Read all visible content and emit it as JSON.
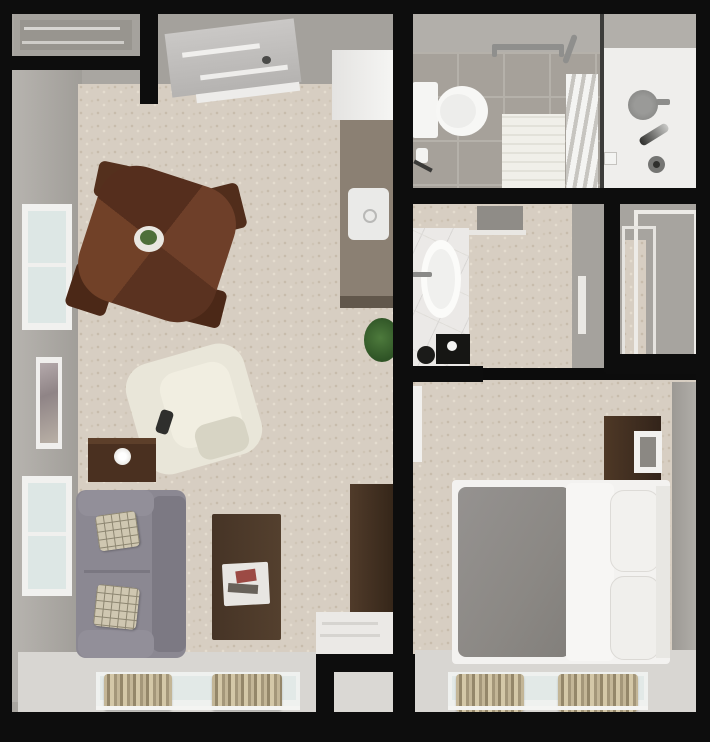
{
  "scene": {
    "width": 710,
    "height": 745,
    "type": "3d-top-view-floor-plan"
  },
  "palette": {
    "wall_line": "#0d0d0d",
    "wall_face": "#a9a6a1",
    "carpet": "#d7cec2",
    "bay_floor": "#d8d6d2",
    "tile": "#a6a19a",
    "counter": "#8b8073",
    "wood_dark": "#4b2817",
    "wood_walnut": "#4c3827",
    "sofa_gray": "#8b8892",
    "recliner_cream": "#e9e6d9",
    "bed_gray": "#8f8c88",
    "curtain_tan": "#b3a687",
    "plant_green": "#4d7a3c",
    "fixture_white": "#f5f5f3"
  },
  "primitives": [
    {
      "n": "living-unit-wall-base",
      "x": 12,
      "y": 12,
      "w": 383,
      "h": 700,
      "bg": "#a9a6a1"
    },
    {
      "n": "living-west-wall-face",
      "x": 12,
      "y": 68,
      "w": 70,
      "h": 634,
      "bg": "linear-gradient(90deg,#b7b4af,#a09d98)"
    },
    {
      "n": "entry-ceiling-area",
      "x": 150,
      "y": 12,
      "w": 245,
      "h": 100,
      "bg": "#a4a19c"
    },
    {
      "n": "living-room-carpet",
      "x": 78,
      "y": 84,
      "w": 317,
      "h": 576,
      "cls": "carpet"
    },
    {
      "n": "living-window-bay-floor",
      "x": 18,
      "y": 652,
      "w": 377,
      "h": 60,
      "bg": "#d8d6d2"
    },
    {
      "n": "bathroom-base",
      "x": 411,
      "y": 12,
      "w": 285,
      "h": 178,
      "bg": "#b2afaa"
    },
    {
      "n": "bathroom-tile-floor",
      "x": 411,
      "y": 52,
      "w": 192,
      "h": 138,
      "cls": "tile"
    },
    {
      "n": "shower-floor",
      "x": 603,
      "y": 48,
      "w": 93,
      "h": 142,
      "bg": "#efeeec"
    },
    {
      "n": "dressing-room-carpet",
      "x": 411,
      "y": 204,
      "w": 194,
      "h": 164,
      "cls": "carpet"
    },
    {
      "n": "dressing-east-wall-face",
      "x": 572,
      "y": 204,
      "w": 32,
      "h": 164,
      "bg": "#a5a29d"
    },
    {
      "n": "closet-base",
      "x": 620,
      "y": 204,
      "w": 76,
      "h": 154,
      "bg": "#a7a49f"
    },
    {
      "n": "closet-carpet-sliver",
      "x": 622,
      "y": 240,
      "w": 24,
      "h": 116,
      "cls": "carpet"
    },
    {
      "n": "bedroom-carpet",
      "x": 411,
      "y": 380,
      "w": 285,
      "h": 274,
      "cls": "carpet"
    },
    {
      "n": "bedroom-window-bay-floor",
      "x": 415,
      "y": 650,
      "w": 281,
      "h": 62,
      "bg": "#d8d6d2"
    },
    {
      "n": "bedroom-east-wall-face",
      "x": 672,
      "y": 382,
      "w": 24,
      "h": 268,
      "bg": "linear-gradient(270deg,#b0ada8,#9c9994)"
    },
    {
      "n": "utility-nook-floor",
      "x": 334,
      "y": 670,
      "w": 58,
      "h": 44,
      "bg": "#dad8d4"
    },
    {
      "n": "entry-alcove",
      "x": 14,
      "y": 14,
      "w": 126,
      "h": 42,
      "bg": "#a5a29d"
    },
    {
      "n": "entry-alcove-shelf",
      "x": 20,
      "y": 20,
      "w": 112,
      "h": 30,
      "bg": "#98958f"
    },
    {
      "n": "alcove-shelf-line-1",
      "x": 24,
      "y": 27,
      "w": 96,
      "h": 3,
      "bg": "#d8d6d2"
    },
    {
      "n": "alcove-shelf-line-2",
      "x": 22,
      "y": 41,
      "w": 102,
      "h": 3,
      "bg": "#cfcdc9"
    },
    {
      "n": "entry-door-panel",
      "x": 168,
      "y": 26,
      "w": 130,
      "h": 64,
      "bg": "linear-gradient(180deg,#cac8c6,#b5b3b1)",
      "rot": -7
    },
    {
      "n": "entry-door-stripe-1",
      "x": 182,
      "y": 48,
      "w": 78,
      "h": 5,
      "bg": "#f0efed",
      "rot": -7
    },
    {
      "n": "entry-door-stripe-2",
      "x": 200,
      "y": 70,
      "w": 88,
      "h": 5,
      "bg": "#eeedeb",
      "rot": -7
    },
    {
      "n": "entry-door-handle",
      "x": 262,
      "y": 56,
      "w": 9,
      "h": 8,
      "bg": "#4a4a48",
      "r": "50%"
    },
    {
      "n": "entry-door-threshold",
      "x": 196,
      "y": 88,
      "w": 104,
      "h": 9,
      "bg": "#edecea",
      "rot": -7
    },
    {
      "n": "refrigerator",
      "x": 332,
      "y": 50,
      "w": 64,
      "h": 70,
      "bg": "linear-gradient(90deg,#e4e3e1,#f6f6f4)"
    },
    {
      "n": "kitchen-counter",
      "x": 340,
      "y": 120,
      "w": 57,
      "h": 188,
      "bg": "#8b8073"
    },
    {
      "n": "kitchen-counter-edge",
      "x": 340,
      "y": 296,
      "w": 57,
      "h": 12,
      "bg": "#61574b"
    },
    {
      "n": "kitchen-sink",
      "x": 348,
      "y": 188,
      "w": 41,
      "h": 52,
      "bg": "#eaeae8",
      "r": "6px"
    },
    {
      "n": "kitchen-faucet",
      "x": 363,
      "y": 209,
      "w": 10,
      "h": 10,
      "bg": "transparent",
      "b": "2px solid #b9b9b7",
      "r": "50%"
    },
    {
      "n": "potted-plant",
      "x": 364,
      "y": 318,
      "w": 36,
      "h": 44,
      "bg": "radial-gradient(circle at 45% 45%,#4d7a3c,#2f5426 70%)",
      "r": "50%"
    },
    {
      "n": "west-window-1-frame",
      "x": 22,
      "y": 204,
      "w": 50,
      "h": 126,
      "bg": "#f1f1ef"
    },
    {
      "n": "west-window-1-glass",
      "x": 28,
      "y": 211,
      "w": 38,
      "h": 112,
      "bg": "#dde7e5"
    },
    {
      "n": "west-window-1-mullion",
      "x": 28,
      "y": 263,
      "w": 38,
      "h": 4,
      "bg": "#f0f0ee"
    },
    {
      "n": "wall-artwork-frame",
      "x": 36,
      "y": 357,
      "w": 26,
      "h": 92,
      "bg": "#f0efed"
    },
    {
      "n": "wall-artwork-print",
      "x": 40,
      "y": 363,
      "w": 18,
      "h": 80,
      "bg": "linear-gradient(160deg,#b4a9ab 0%,#8f8486 40%,#b9b0a6 100%)"
    },
    {
      "n": "west-window-2-frame",
      "x": 22,
      "y": 476,
      "w": 50,
      "h": 120,
      "bg": "#f1f1ef"
    },
    {
      "n": "west-window-2-glass",
      "x": 28,
      "y": 483,
      "w": 38,
      "h": 106,
      "bg": "#dde7e5"
    },
    {
      "n": "west-window-2-mullion",
      "x": 28,
      "y": 532,
      "w": 38,
      "h": 4,
      "bg": "#f0f0ee"
    },
    {
      "n": "dining-chair-top",
      "x": 96,
      "y": 164,
      "w": 42,
      "h": 36,
      "bg": "#54301d",
      "r": "6px",
      "rot": 12
    },
    {
      "n": "dining-chair-right",
      "x": 203,
      "y": 186,
      "w": 40,
      "h": 46,
      "bg": "#512d1b",
      "r": "6px",
      "rot": -14
    },
    {
      "n": "dining-chair-bottom",
      "x": 176,
      "y": 286,
      "w": 48,
      "h": 38,
      "bg": "#4b2817",
      "r": "6px",
      "rot": 14
    },
    {
      "n": "dining-chair-left",
      "x": 70,
      "y": 266,
      "w": 42,
      "h": 46,
      "bg": "#4b2817",
      "r": "6px",
      "rot": 18
    },
    {
      "n": "dining-table",
      "x": 86,
      "y": 174,
      "w": 142,
      "h": 140,
      "bg": "conic-gradient(from 20deg,#6e3f29 0 25%,#5a3220 0 50%,#714128 0 75%,#552e1d 0 100%)",
      "r": "28%",
      "rot": 18
    },
    {
      "n": "table-centerpiece-plate",
      "x": 134,
      "y": 226,
      "w": 30,
      "h": 26,
      "bg": "#e9e7e1",
      "r": "50%"
    },
    {
      "n": "table-centerpiece-plant",
      "x": 140,
      "y": 230,
      "w": 17,
      "h": 15,
      "bg": "#4e6f3a",
      "r": "50%"
    },
    {
      "n": "recliner-body",
      "x": 133,
      "y": 352,
      "w": 122,
      "h": 114,
      "bg": "#e9e6d9",
      "r": "26px",
      "rot": -16
    },
    {
      "n": "recliner-seat",
      "x": 165,
      "y": 366,
      "w": 72,
      "h": 78,
      "bg": "#f1eee1",
      "r": "18px",
      "rot": -16
    },
    {
      "n": "recliner-arm-shadow",
      "x": 196,
      "y": 420,
      "w": 52,
      "h": 36,
      "bg": "#d7d4c4",
      "r": "12px",
      "rot": -16
    },
    {
      "n": "recliner-remote",
      "x": 158,
      "y": 410,
      "w": 13,
      "h": 24,
      "bg": "#2f2f2d",
      "r": "4px",
      "rot": 18
    },
    {
      "n": "side-table",
      "x": 88,
      "y": 438,
      "w": 68,
      "h": 44,
      "bg": "#4a3020"
    },
    {
      "n": "side-table-top-edge",
      "x": 88,
      "y": 438,
      "w": 68,
      "h": 6,
      "bg": "#5d3f2a"
    },
    {
      "n": "table-lamp",
      "x": 114,
      "y": 448,
      "w": 17,
      "h": 17,
      "bg": "radial-gradient(circle,#ffffff 30%,#d9d7d1)",
      "r": "50%"
    },
    {
      "n": "sofa-body",
      "x": 76,
      "y": 490,
      "w": 110,
      "h": 168,
      "bg": "#8b8892",
      "r": "10px"
    },
    {
      "n": "sofa-back-cushion",
      "x": 152,
      "y": 496,
      "w": 34,
      "h": 156,
      "bg": "#7c7983",
      "r": "8px"
    },
    {
      "n": "sofa-arm-top",
      "x": 78,
      "y": 490,
      "w": 76,
      "h": 26,
      "bg": "#928f99",
      "r": "10px"
    },
    {
      "n": "sofa-arm-bottom",
      "x": 78,
      "y": 630,
      "w": 76,
      "h": 28,
      "bg": "#928f99",
      "r": "10px"
    },
    {
      "n": "sofa-seat-seam",
      "x": 84,
      "y": 570,
      "w": 66,
      "h": 3,
      "bg": "#7a7781"
    },
    {
      "n": "sofa-pillow-1",
      "x": 97,
      "y": 513,
      "w": 41,
      "h": 36,
      "cls": "plaid",
      "rot": -8
    },
    {
      "n": "sofa-pillow-2",
      "x": 95,
      "y": 586,
      "w": 43,
      "h": 42,
      "cls": "plaid",
      "rot": 6
    },
    {
      "n": "coffee-table",
      "x": 212,
      "y": 514,
      "w": 69,
      "h": 126,
      "bg": "linear-gradient(90deg,#463426,#54402e)",
      "r": "2px"
    },
    {
      "n": "magazine-stack",
      "x": 223,
      "y": 563,
      "w": 46,
      "h": 42,
      "bg": "#e8e6e2",
      "r": "2px",
      "rot": -3
    },
    {
      "n": "magazine-red",
      "x": 236,
      "y": 570,
      "w": 20,
      "h": 12,
      "bg": "#9c4a44",
      "rot": -8
    },
    {
      "n": "magazine-dark",
      "x": 228,
      "y": 584,
      "w": 30,
      "h": 9,
      "bg": "#68625a",
      "rot": 4
    },
    {
      "n": "wardrobe-cabinet",
      "x": 350,
      "y": 484,
      "w": 44,
      "h": 130,
      "bg": "linear-gradient(90deg,#503b2a,#352619)"
    },
    {
      "n": "white-dresser",
      "x": 316,
      "y": 612,
      "w": 78,
      "h": 44,
      "bg": "#ebe9e6"
    },
    {
      "n": "white-dresser-line-1",
      "x": 322,
      "y": 622,
      "w": 56,
      "h": 3,
      "bg": "#d6d4d0"
    },
    {
      "n": "white-dresser-line-2",
      "x": 320,
      "y": 634,
      "w": 60,
      "h": 3,
      "bg": "#d6d4d0"
    },
    {
      "n": "living-south-window-frame",
      "x": 96,
      "y": 672,
      "w": 204,
      "h": 38,
      "bg": "#eff1ef"
    },
    {
      "n": "living-south-window-glass",
      "x": 100,
      "y": 676,
      "w": 196,
      "h": 24,
      "bg": "#e2e9e7"
    },
    {
      "n": "living-south-curtain-left",
      "x": 104,
      "y": 674,
      "w": 68,
      "h": 36,
      "cls": "curtain"
    },
    {
      "n": "living-south-curtain-right",
      "x": 212,
      "y": 674,
      "w": 70,
      "h": 36,
      "cls": "curtain"
    },
    {
      "n": "living-south-window-sill",
      "x": 96,
      "y": 706,
      "w": 204,
      "h": 4,
      "bg": "#f4f4f2"
    },
    {
      "n": "toilet-tank",
      "x": 412,
      "y": 82,
      "w": 26,
      "h": 56,
      "bg": "#f5f5f3",
      "r": "3px"
    },
    {
      "n": "toilet-bowl",
      "x": 436,
      "y": 86,
      "w": 52,
      "h": 50,
      "bg": "#f7f7f5",
      "r": "50%"
    },
    {
      "n": "toilet-seat-shadow",
      "x": 440,
      "y": 94,
      "w": 36,
      "h": 34,
      "bg": "#ededeb",
      "r": "50%"
    },
    {
      "n": "toilet-paper-roll",
      "x": 416,
      "y": 148,
      "w": 12,
      "h": 15,
      "bg": "#f3f3f1",
      "r": "3px"
    },
    {
      "n": "toilet-paper-bracket",
      "x": 413,
      "y": 164,
      "w": 20,
      "h": 4,
      "bg": "#3a3a38",
      "rot": 28
    },
    {
      "n": "bath-mat",
      "x": 502,
      "y": 114,
      "w": 63,
      "h": 74,
      "cls": "mat"
    },
    {
      "n": "grab-bar",
      "x": 492,
      "y": 44,
      "w": 72,
      "h": 6,
      "bg": "#8f8f8d",
      "r": "3px"
    },
    {
      "n": "grab-bar-end-left",
      "x": 492,
      "y": 44,
      "w": 5,
      "h": 13,
      "bg": "#8f8f8d",
      "r": "2px"
    },
    {
      "n": "grab-bar-end-right",
      "x": 559,
      "y": 44,
      "w": 5,
      "h": 13,
      "bg": "#8f8f8d",
      "r": "2px"
    },
    {
      "n": "grab-bar-angled",
      "x": 567,
      "y": 34,
      "w": 6,
      "h": 30,
      "bg": "#8f8f8d",
      "r": "3px",
      "rot": 20
    },
    {
      "n": "towel-shelf",
      "x": 566,
      "y": 74,
      "w": 32,
      "h": 114,
      "cls": "towels"
    },
    {
      "n": "shower-glass-partition",
      "x": 600,
      "y": 12,
      "w": 4,
      "h": 178,
      "bg": "#3c3c3a"
    },
    {
      "n": "shower-head",
      "x": 628,
      "y": 90,
      "w": 30,
      "h": 30,
      "bg": "radial-gradient(circle,#9a9a98 40%,#7f7f7d)",
      "r": "50%"
    },
    {
      "n": "shower-head-arm",
      "x": 656,
      "y": 99,
      "w": 14,
      "h": 6,
      "bg": "#8d8d8b",
      "r": "2px"
    },
    {
      "n": "hand-sprayer",
      "x": 638,
      "y": 130,
      "w": 32,
      "h": 9,
      "bg": "linear-gradient(90deg,#2e2e2c,#c9c9c7)",
      "r": "4px",
      "rot": -32
    },
    {
      "n": "shower-valve",
      "x": 648,
      "y": 156,
      "w": 17,
      "h": 17,
      "bg": "#757573",
      "r": "50%"
    },
    {
      "n": "shower-valve-center",
      "x": 653,
      "y": 161,
      "w": 7,
      "h": 7,
      "bg": "#2f2f2d",
      "r": "50%"
    },
    {
      "n": "soap-niche",
      "x": 604,
      "y": 152,
      "w": 11,
      "h": 11,
      "bg": "#f4f4f2",
      "b": "1px solid #c5c3bf"
    },
    {
      "n": "dressing-floor-mat",
      "x": 477,
      "y": 206,
      "w": 46,
      "h": 26,
      "bg": "#8f8c87"
    },
    {
      "n": "dressing-shelf-edge",
      "x": 450,
      "y": 230,
      "w": 76,
      "h": 5,
      "bg": "#e9e7e3"
    },
    {
      "n": "vanity-counter",
      "x": 411,
      "y": 228,
      "w": 58,
      "h": 141,
      "cls": "marble"
    },
    {
      "n": "vanity-sink",
      "x": 421,
      "y": 240,
      "w": 40,
      "h": 78,
      "bg": "#fbfbf9",
      "r": "50%"
    },
    {
      "n": "vanity-sink-inner",
      "x": 427,
      "y": 249,
      "w": 28,
      "h": 60,
      "bg": "#f0f0ee",
      "r": "50%"
    },
    {
      "n": "vanity-faucet",
      "x": 412,
      "y": 272,
      "w": 20,
      "h": 5,
      "bg": "#8a8a88",
      "r": "2px"
    },
    {
      "n": "vanity-black-tray",
      "x": 436,
      "y": 334,
      "w": 34,
      "h": 30,
      "bg": "#161614"
    },
    {
      "n": "vanity-tray-dot",
      "x": 447,
      "y": 341,
      "w": 10,
      "h": 10,
      "bg": "#f5f5f3",
      "r": "50%"
    },
    {
      "n": "vanity-stool",
      "x": 417,
      "y": 346,
      "w": 18,
      "h": 18,
      "bg": "#1b1b19",
      "r": "50%"
    },
    {
      "n": "dressing-door-trim",
      "x": 578,
      "y": 276,
      "w": 8,
      "h": 58,
      "bg": "#eae8e4"
    },
    {
      "n": "closet-sliding-door-outer",
      "x": 634,
      "y": 210,
      "w": 56,
      "h": 142,
      "bg": "transparent",
      "b": "4px solid #edebe7"
    },
    {
      "n": "closet-sliding-door-inner",
      "x": 622,
      "y": 226,
      "w": 28,
      "h": 126,
      "bg": "transparent",
      "b": "3px solid #e6e4e0"
    },
    {
      "n": "bedroom-open-door",
      "x": 413,
      "y": 386,
      "w": 9,
      "h": 76,
      "bg": "#f1f0ee"
    },
    {
      "n": "nightstand-dresser",
      "x": 604,
      "y": 416,
      "w": 57,
      "h": 71,
      "bg": "linear-gradient(90deg,#4e3826,#33241a)"
    },
    {
      "n": "nightstand-mirror",
      "x": 634,
      "y": 431,
      "w": 28,
      "h": 42,
      "bg": "#f2f1ef"
    },
    {
      "n": "nightstand-mirror-inner",
      "x": 640,
      "y": 437,
      "w": 16,
      "h": 30,
      "bg": "#8b8883"
    },
    {
      "n": "bed-frame",
      "x": 452,
      "y": 480,
      "w": 218,
      "h": 184,
      "bg": "#f3f2f0",
      "r": "4px"
    },
    {
      "n": "bed-duvet",
      "x": 458,
      "y": 487,
      "w": 112,
      "h": 170,
      "bg": "linear-gradient(120deg,#959290 0%,#8b8884 60%,#827f7b 100%)",
      "r": "8px"
    },
    {
      "n": "bed-sheet-fold",
      "x": 566,
      "y": 483,
      "w": 48,
      "h": 178,
      "bg": "#f7f6f4",
      "r": "6px"
    },
    {
      "n": "bed-pillow-1",
      "x": 610,
      "y": 490,
      "w": 48,
      "h": 80,
      "bg": "#f2f1ee",
      "r": "14px",
      "b": "1px solid #dddbd7"
    },
    {
      "n": "bed-pillow-2",
      "x": 610,
      "y": 576,
      "w": 48,
      "h": 82,
      "bg": "#f0efec",
      "r": "14px",
      "b": "1px solid #dbd9d5"
    },
    {
      "n": "bed-headboard",
      "x": 656,
      "y": 486,
      "w": 14,
      "h": 172,
      "bg": "#e8e7e3"
    },
    {
      "n": "bedroom-south-window-frame",
      "x": 448,
      "y": 672,
      "w": 200,
      "h": 38,
      "bg": "#eff1ef"
    },
    {
      "n": "bedroom-south-window-glass",
      "x": 452,
      "y": 676,
      "w": 192,
      "h": 24,
      "bg": "#e2e9e7"
    },
    {
      "n": "bedroom-south-curtain-left",
      "x": 456,
      "y": 674,
      "w": 68,
      "h": 38,
      "cls": "curtain"
    },
    {
      "n": "bedroom-south-curtain-right",
      "x": 558,
      "y": 674,
      "w": 80,
      "h": 38,
      "cls": "curtain"
    },
    {
      "n": "bedroom-south-window-sill",
      "x": 448,
      "y": 706,
      "w": 200,
      "h": 4,
      "bg": "#f4f4f2"
    },
    {
      "n": "wall-frame-top",
      "x": 0,
      "y": 0,
      "w": 710,
      "h": 14,
      "cls": "wall"
    },
    {
      "n": "wall-frame-left",
      "x": 0,
      "y": 0,
      "w": 10,
      "h": 742,
      "cls": "wall"
    },
    {
      "n": "wall-frame-right",
      "x": 696,
      "y": 0,
      "w": 14,
      "h": 742,
      "cls": "wall"
    },
    {
      "n": "wall-frame-bottom",
      "x": 0,
      "y": 712,
      "w": 710,
      "h": 30,
      "cls": "wall"
    },
    {
      "n": "wall-alcove-bottom",
      "x": 6,
      "y": 56,
      "w": 140,
      "h": 14,
      "cls": "wall"
    },
    {
      "n": "wall-alcove-right",
      "x": 140,
      "y": 12,
      "w": 18,
      "h": 92,
      "cls": "wall"
    },
    {
      "n": "wall-central",
      "x": 393,
      "y": 12,
      "w": 20,
      "h": 700,
      "cls": "wall"
    },
    {
      "n": "wall-bathroom-south",
      "x": 405,
      "y": 188,
      "w": 305,
      "h": 16,
      "cls": "wall"
    },
    {
      "n": "wall-dressing-south",
      "x": 405,
      "y": 366,
      "w": 78,
      "h": 16,
      "cls": "wall"
    },
    {
      "n": "wall-closet-west",
      "x": 604,
      "y": 204,
      "w": 16,
      "h": 168,
      "cls": "wall"
    },
    {
      "n": "wall-closet-south",
      "x": 606,
      "y": 354,
      "w": 104,
      "h": 20,
      "cls": "wall"
    },
    {
      "n": "wall-nook-top",
      "x": 316,
      "y": 654,
      "w": 92,
      "h": 18,
      "cls": "wall"
    },
    {
      "n": "wall-nook-left",
      "x": 316,
      "y": 668,
      "w": 18,
      "h": 58,
      "cls": "wall"
    },
    {
      "n": "bottom-white-margin",
      "x": 0,
      "y": 742,
      "w": 710,
      "h": 3,
      "bg": "#ffffff",
      "z": 60
    }
  ]
}
